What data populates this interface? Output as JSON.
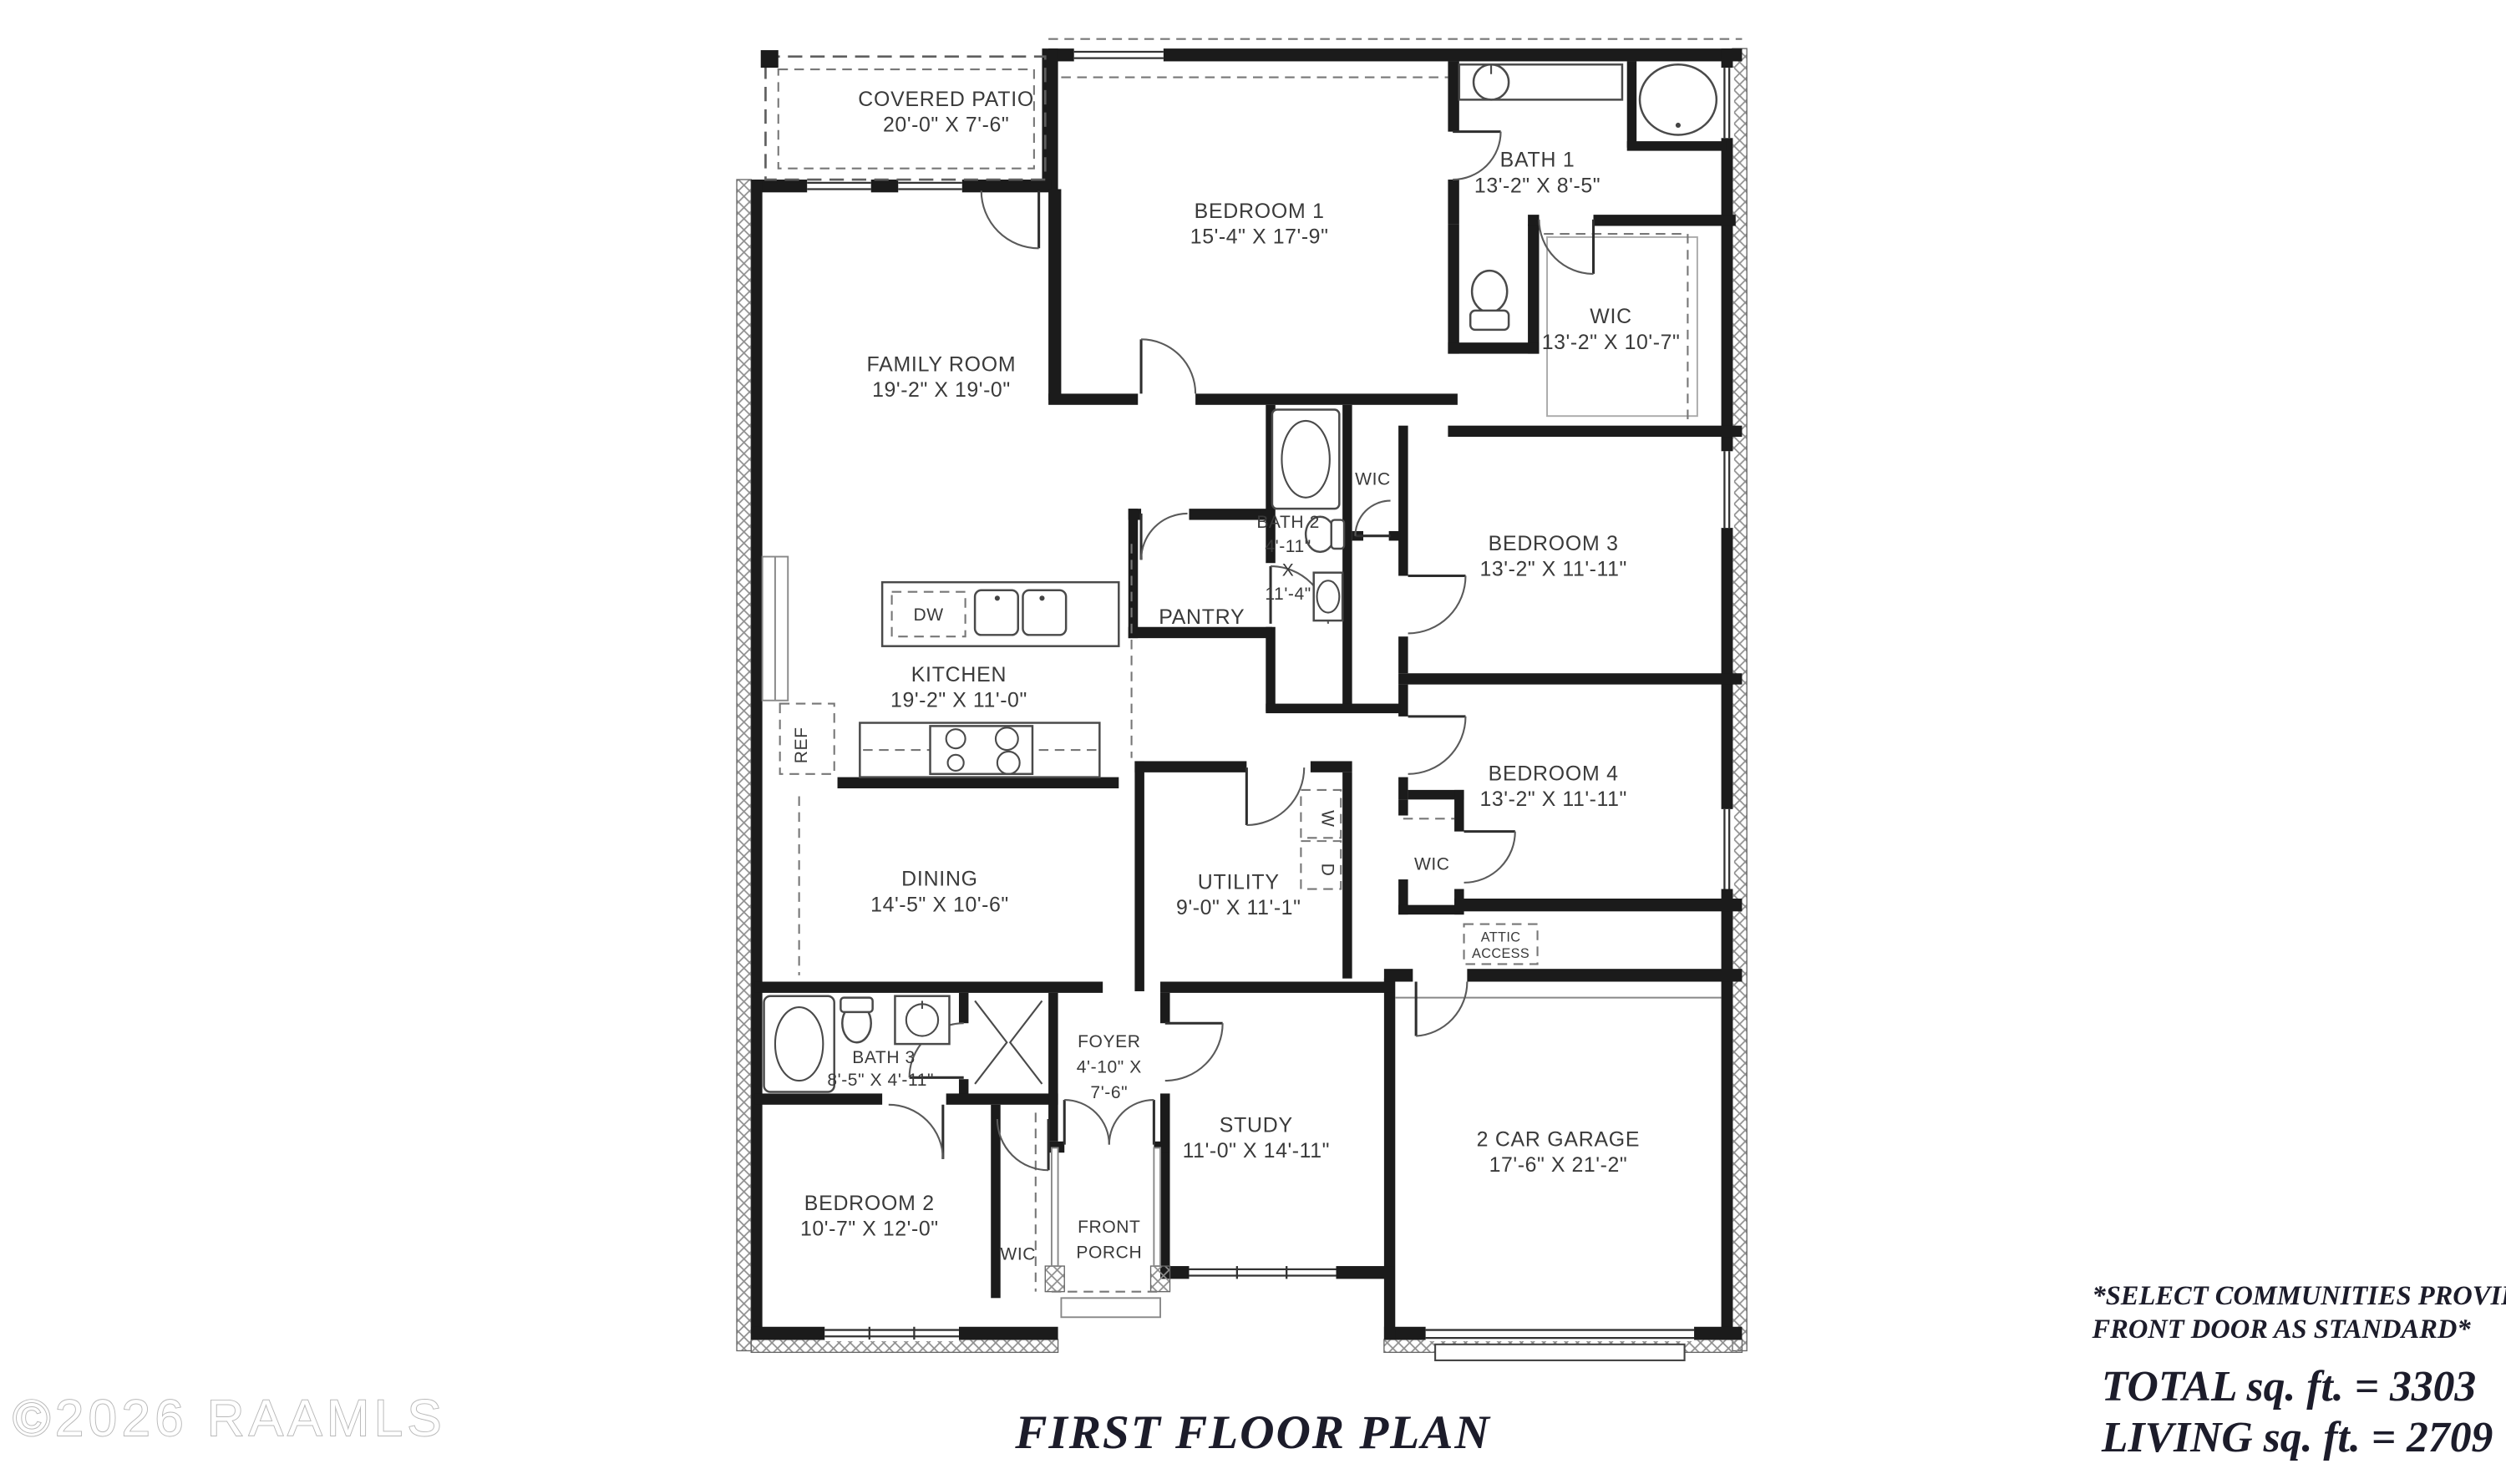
{
  "plan": {
    "title": "FIRST FLOOR PLAN",
    "watermark": "©2026 RAAMLS",
    "annotations": {
      "note_line1": "*SELECT COMMUNITIES PROVIDE 8’",
      "note_line2": "FRONT DOOR AS STANDARD*",
      "total_sqft": "TOTAL sq. ft. = 3303",
      "living_sqft": "LIVING sq. ft. = 2709"
    },
    "rooms": {
      "covered_patio": {
        "name": "COVERED PATIO",
        "dims": "20'-0\" X 7'-6\""
      },
      "family_room": {
        "name": "FAMILY ROOM",
        "dims": "19'-2\" X 19'-0\""
      },
      "bedroom_1": {
        "name": "BEDROOM 1",
        "dims": "15'-4\" X 17'-9\""
      },
      "bath_1": {
        "name": "BATH 1",
        "dims": "13'-2\" X 8'-5\""
      },
      "wic_primary": {
        "name": "WIC",
        "dims": "13'-2\" X 10'-7\""
      },
      "bedroom_3": {
        "name": "BEDROOM 3",
        "dims": "13'-2\" X 11'-11\""
      },
      "bedroom_4": {
        "name": "BEDROOM 4",
        "dims": "13'-2\" X 11'-11\""
      },
      "bath_2": {
        "name": "BATH 2",
        "width": "4'-11\"",
        "by": "X",
        "length": "11'-4\""
      },
      "pantry": {
        "name": "PANTRY"
      },
      "wic_hall": {
        "name": "WIC"
      },
      "kitchen": {
        "name": "KITCHEN",
        "dims": "19'-2\" X 11'-0\""
      },
      "dining": {
        "name": "DINING",
        "dims": "14'-5\" X 10'-6\""
      },
      "utility": {
        "name": "UTILITY",
        "dims": "9'-0\" X 11'-1\""
      },
      "wic_bedroom4": {
        "name": "WIC"
      },
      "attic_access": {
        "line1": "ATTIC",
        "line2": "ACCESS"
      },
      "garage": {
        "name": "2 CAR GARAGE",
        "dims": "17'-6\" X 21'-2\""
      },
      "bath_3": {
        "name": "BATH 3",
        "dims": "8'-5\" X 4'-11\""
      },
      "foyer": {
        "name": "FOYER",
        "dims_line1": "4'-10\" X",
        "dims_line2": "7'-6\""
      },
      "study": {
        "name": "STUDY",
        "dims": "11'-0\" X 14'-11\""
      },
      "bedroom_2": {
        "name": "BEDROOM 2",
        "dims": "10'-7\" X 12'-0\""
      },
      "wic_bedroom2": {
        "name": "WIC"
      },
      "front_porch": {
        "line1": "FRONT",
        "line2": "PORCH"
      }
    },
    "appliances": {
      "ref": "REF",
      "dw": "DW",
      "washer": "W",
      "dryer": "D"
    }
  }
}
